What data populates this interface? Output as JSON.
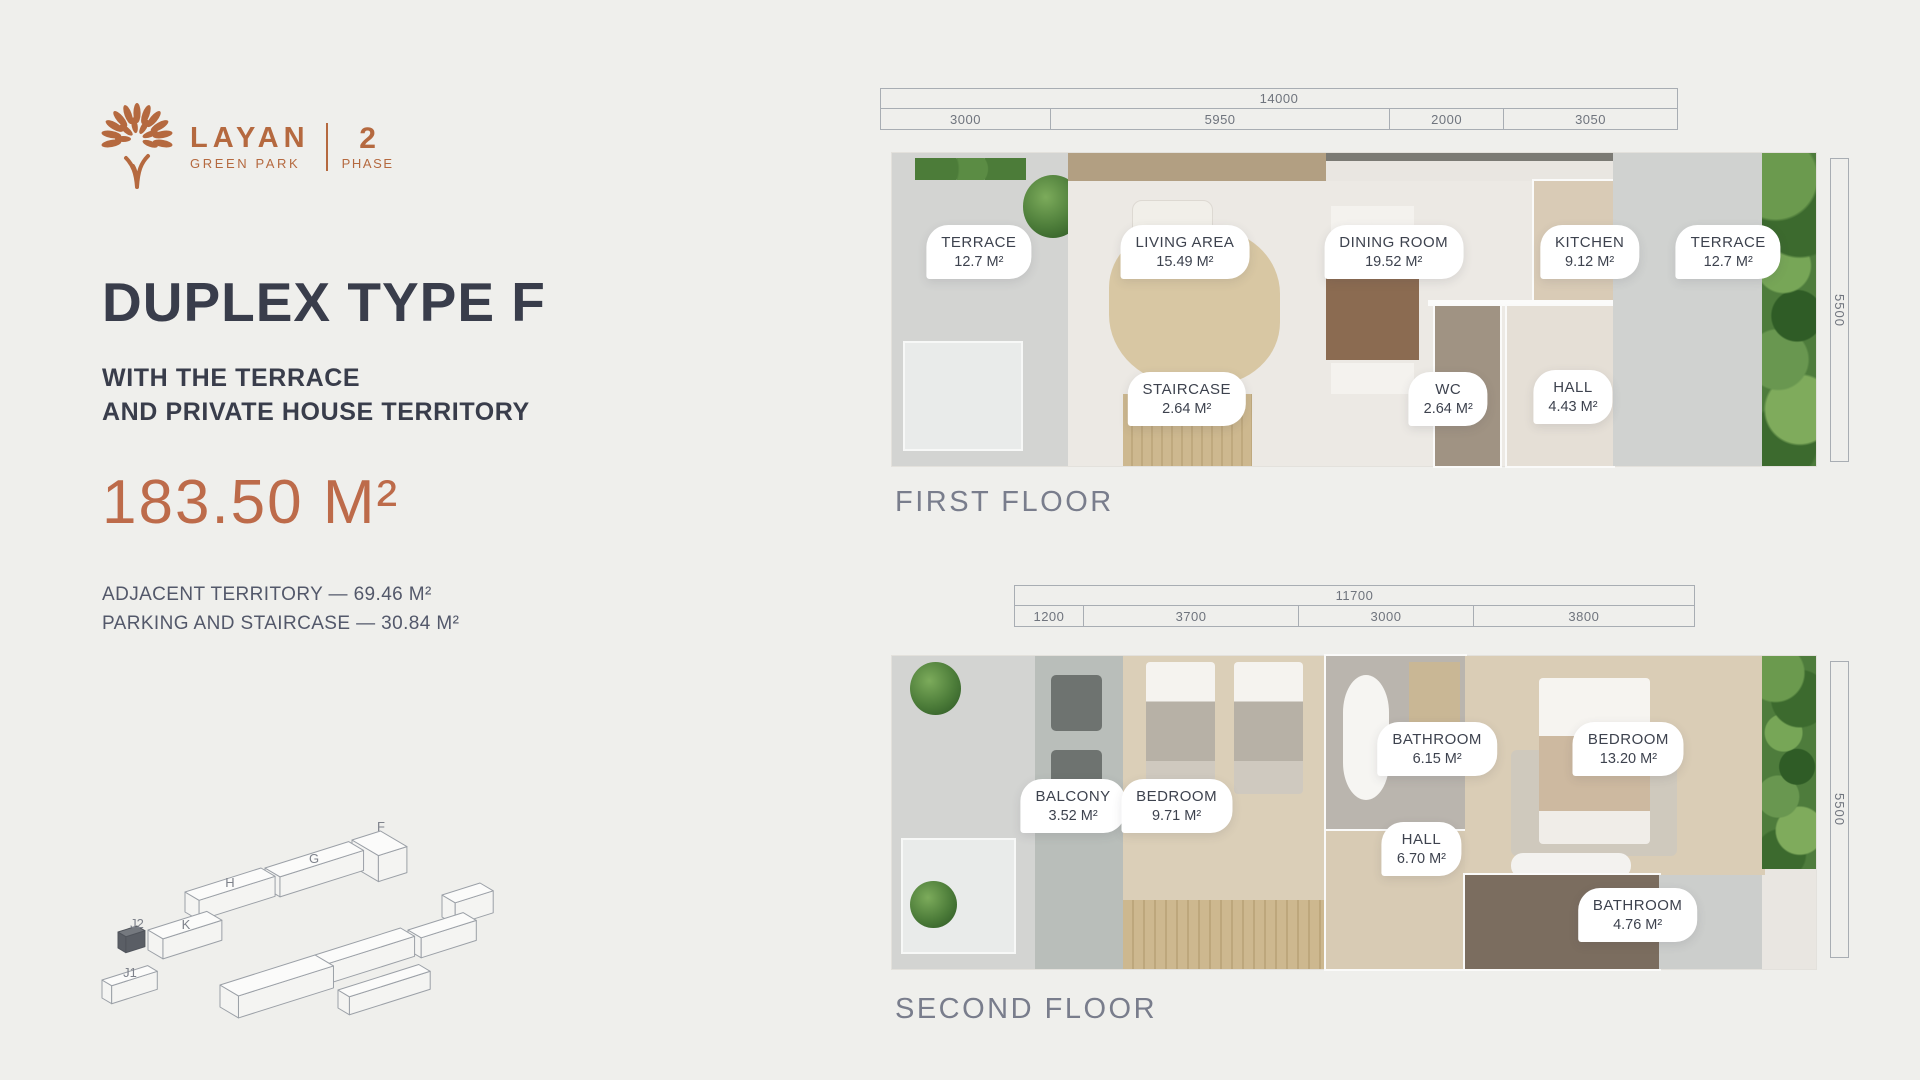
{
  "logo": {
    "brand": "LAYAN",
    "sub": "GREEN PARK",
    "phase_number": "2",
    "phase_label": "PHASE",
    "accent_color": "#b5693f"
  },
  "hero": {
    "title": "DUPLEX TYPE F",
    "subtitle_line1": "WITH THE TERRACE",
    "subtitle_line2": "AND PRIVATE HOUSE TERRITORY",
    "total_area": "183.50 M²",
    "detail_line1": "ADJACENT TERRITORY — 69.46 M²",
    "detail_line2": "PARKING AND STAIRCASE — 30.84 M²"
  },
  "floors": [
    {
      "name": "FIRST FLOOR",
      "side_dim": "5500",
      "dims": {
        "total": "14000",
        "segments": [
          {
            "label": "3000",
            "pct": 21.43
          },
          {
            "label": "5950",
            "pct": 42.5
          },
          {
            "label": "2000",
            "pct": 14.28
          },
          {
            "label": "3050",
            "pct": 21.79
          }
        ]
      },
      "rooms": [
        {
          "name": "TERRACE",
          "area": "12.7 M²",
          "x": 9.4,
          "y": 31.6
        },
        {
          "name": "LIVING AREA",
          "area": "15.49 M²",
          "x": 31.7,
          "y": 31.6
        },
        {
          "name": "DINING ROOM",
          "area": "19.52 M²",
          "x": 54.3,
          "y": 31.6
        },
        {
          "name": "KITCHEN",
          "area": "9.12 M²",
          "x": 75.5,
          "y": 31.6
        },
        {
          "name": "TERRACE",
          "area": "12.7 M²",
          "x": 90.5,
          "y": 31.6
        },
        {
          "name": "STAIRCASE",
          "area": "2.64 M²",
          "x": 31.9,
          "y": 78.6
        },
        {
          "name": "WC",
          "area": "2.64 M²",
          "x": 60.2,
          "y": 78.6
        },
        {
          "name": "HALL",
          "area": "4.43 M²",
          "x": 73.7,
          "y": 78.0
        }
      ]
    },
    {
      "name": "SECOND FLOOR",
      "side_dim": "5500",
      "dims": {
        "total": "11700",
        "segments": [
          {
            "label": "1200",
            "pct": 10.26
          },
          {
            "label": "3700",
            "pct": 31.62
          },
          {
            "label": "3000",
            "pct": 25.64
          },
          {
            "label": "3800",
            "pct": 32.48
          }
        ]
      },
      "rooms": [
        {
          "name": "BATHROOM",
          "area": "6.15 M²",
          "x": 59.0,
          "y": 29.7
        },
        {
          "name": "BEDROOM",
          "area": "13.20 M²",
          "x": 79.7,
          "y": 29.7
        },
        {
          "name": "BALCONY",
          "area": "3.52 M²",
          "x": 19.6,
          "y": 47.9
        },
        {
          "name": "BEDROOM",
          "area": "9.71 M²",
          "x": 30.8,
          "y": 47.9
        },
        {
          "name": "HALL",
          "area": "6.70 M²",
          "x": 57.3,
          "y": 61.7
        },
        {
          "name": "BATHROOM",
          "area": "4.76 M²",
          "x": 80.7,
          "y": 82.7
        }
      ]
    }
  ],
  "site_map": {
    "highlighted_unit": "J2",
    "buildings": [
      {
        "label": "F",
        "x": 262,
        "y": 40,
        "len": 30,
        "wid": 60,
        "h": 26,
        "lx": 291,
        "ly": 31
      },
      {
        "label": "G",
        "x": 175,
        "y": 68,
        "len": 88,
        "wid": 34,
        "h": 20,
        "lx": 224,
        "ly": 63
      },
      {
        "label": "H",
        "x": 95,
        "y": 92,
        "len": 80,
        "wid": 32,
        "h": 20,
        "lx": 140,
        "ly": 87
      },
      {
        "label": "",
        "x": 352,
        "y": 95,
        "len": 40,
        "wid": 30,
        "h": 22
      },
      {
        "label": "",
        "x": 318,
        "y": 130,
        "len": 58,
        "wid": 30,
        "h": 20
      },
      {
        "label": "",
        "x": 225,
        "y": 155,
        "len": 90,
        "wid": 32,
        "h": 20
      },
      {
        "label": "K",
        "x": 58,
        "y": 130,
        "len": 62,
        "wid": 34,
        "h": 20,
        "lx": 96,
        "ly": 129
      },
      {
        "label": "J2",
        "x": 28,
        "y": 132,
        "len": 20,
        "wid": 18,
        "h": 16,
        "dark": true,
        "lx": 47,
        "ly": 128
      },
      {
        "label": "",
        "x": 130,
        "y": 185,
        "len": 100,
        "wid": 42,
        "h": 22
      },
      {
        "label": "",
        "x": 248,
        "y": 190,
        "len": 85,
        "wid": 26,
        "h": 18
      },
      {
        "label": "J1",
        "x": 12,
        "y": 180,
        "len": 48,
        "wid": 22,
        "h": 18,
        "lx": 40,
        "ly": 177
      }
    ]
  }
}
